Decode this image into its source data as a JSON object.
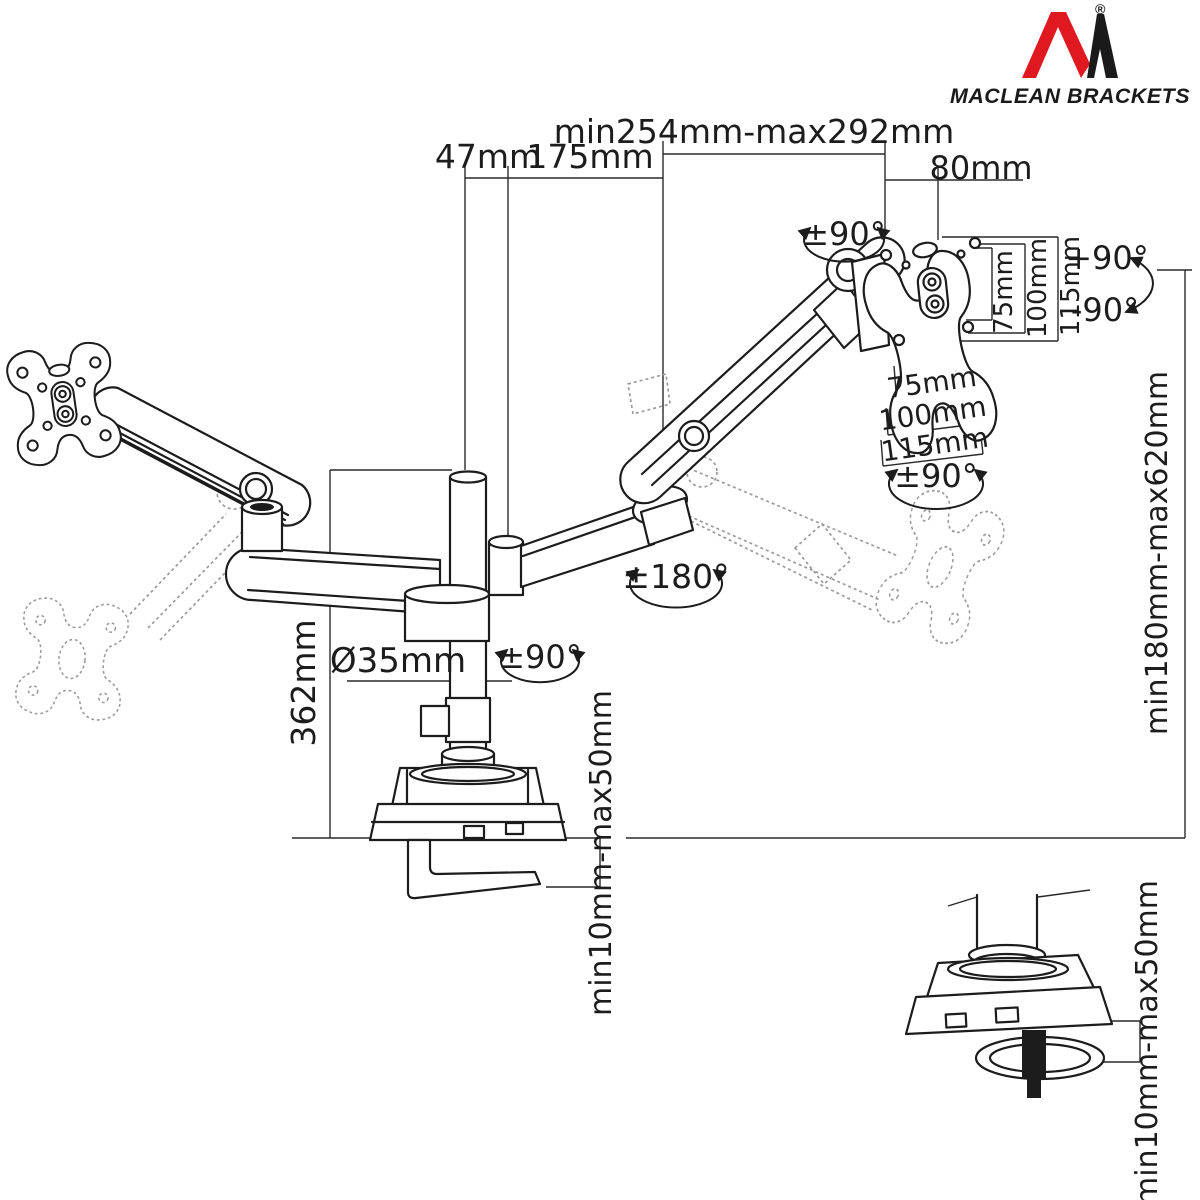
{
  "brand": {
    "name": "MACLEAN BRACKETS",
    "registered": "®"
  },
  "labels": {
    "width_47": "47mm",
    "width_175": "175mm",
    "width_range": "min254mm-max292mm",
    "width_80": "80mm",
    "swivel_top": "±90°",
    "tilt_up": "+90°",
    "tilt_down": "-90°",
    "vesa_v": [
      "75mm",
      "100mm",
      "115mm"
    ],
    "vesa_h": [
      "75mm",
      "100mm",
      "115mm"
    ],
    "vesa_rotation": "±90°",
    "arm_rotation": "±180°",
    "pole_swivel": "±90°",
    "pole_diameter": "Ø35mm",
    "pole_height": "362mm",
    "height_range": "min180mm-max620mm",
    "clamp_thickness": "min10mm-max50mm",
    "clamp_thickness_detail": "min10mm-max50mm"
  },
  "colors": {
    "line": "#1c1c1c",
    "ghost": "#9b9b9b",
    "brand_red": "#e0181f",
    "brand_black": "#1a1a1a",
    "background": "#ffffff"
  }
}
